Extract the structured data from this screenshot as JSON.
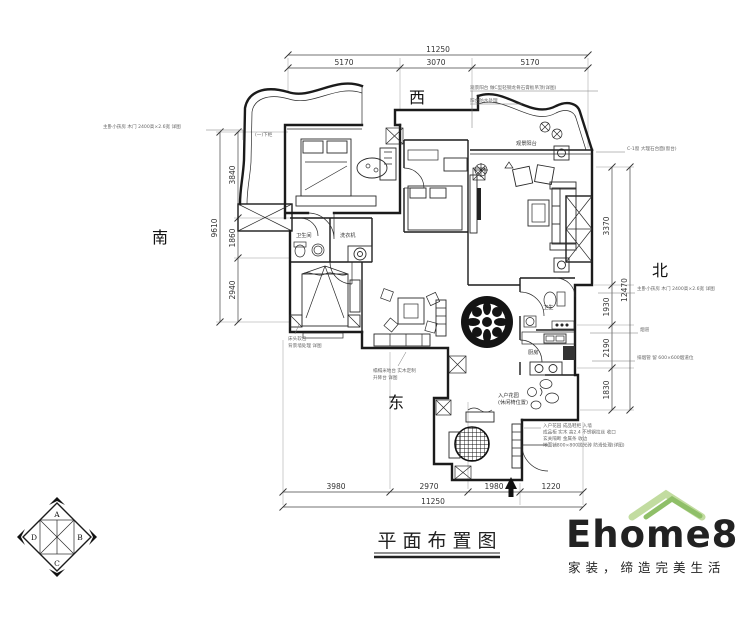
{
  "title": {
    "text": "平面布置图"
  },
  "directions": {
    "west": "西",
    "south": "南",
    "north": "北",
    "east": "东"
  },
  "dimensions": {
    "top": {
      "total": "11250",
      "segments": [
        "5170",
        "3070",
        "5170"
      ]
    },
    "bottom": {
      "total": "11250",
      "segments": [
        "3980",
        "2970",
        "1980",
        "1220"
      ]
    },
    "left": {
      "total": "9610",
      "segments": [
        "3840",
        "1860",
        "2940"
      ]
    },
    "right": {
      "total": "12470",
      "segments": [
        "3370",
        "1930",
        "2190",
        "1830"
      ]
    }
  },
  "rooms": {
    "balcony": "观景阳台",
    "bath_small": "卫生间",
    "laundry": "洗衣机",
    "bath": "卫生",
    "kitchen": "厨房",
    "entry_garden": "入户花园",
    "entry_garden2": "(休闲椅位置)"
  },
  "annotations": {
    "left_note": "主卧小孩房 木门 2400高×2.6宽 详图",
    "top_right_1": "观景阳台 做C型轻钢龙骨石膏板吊顶(详图)",
    "top_right_2": "阳台防水处理",
    "right_top": "C-1窗 大理石台面(窗台)",
    "right_mid": "主卧小孩房 木门 2400高×2.6宽 详图",
    "right_duct": "烟道",
    "right_low": "排烟管 留 600×600烟道位",
    "balcony_cabinet": "(一)下柜",
    "sw_1": "榻榻米地台 实木定制",
    "sw_2": "升降台 详图",
    "bed3_1": "床头软包",
    "bed3_2": "背景墙处理 详图",
    "br_1": "入户花园 成品鞋柜 入墙",
    "br_2": "成品柜 实木 高2.4 不锈钢拉丝 收口",
    "br_3": "玄关隔断 金属条 收边",
    "br_4": "地面铺800×800抛光砖 防滑处理(详图)"
  },
  "compass": {
    "a": "A",
    "b": "B",
    "c": "C",
    "d": "D"
  },
  "logo": {
    "name": "Ehome8",
    "tagline": "家装，缔造完美生活",
    "name_color": "#f7d9ba",
    "tagline_color": "#c3d897",
    "roof_color_dark": "#8fbf68",
    "roof_color_light": "#c2dca0"
  }
}
